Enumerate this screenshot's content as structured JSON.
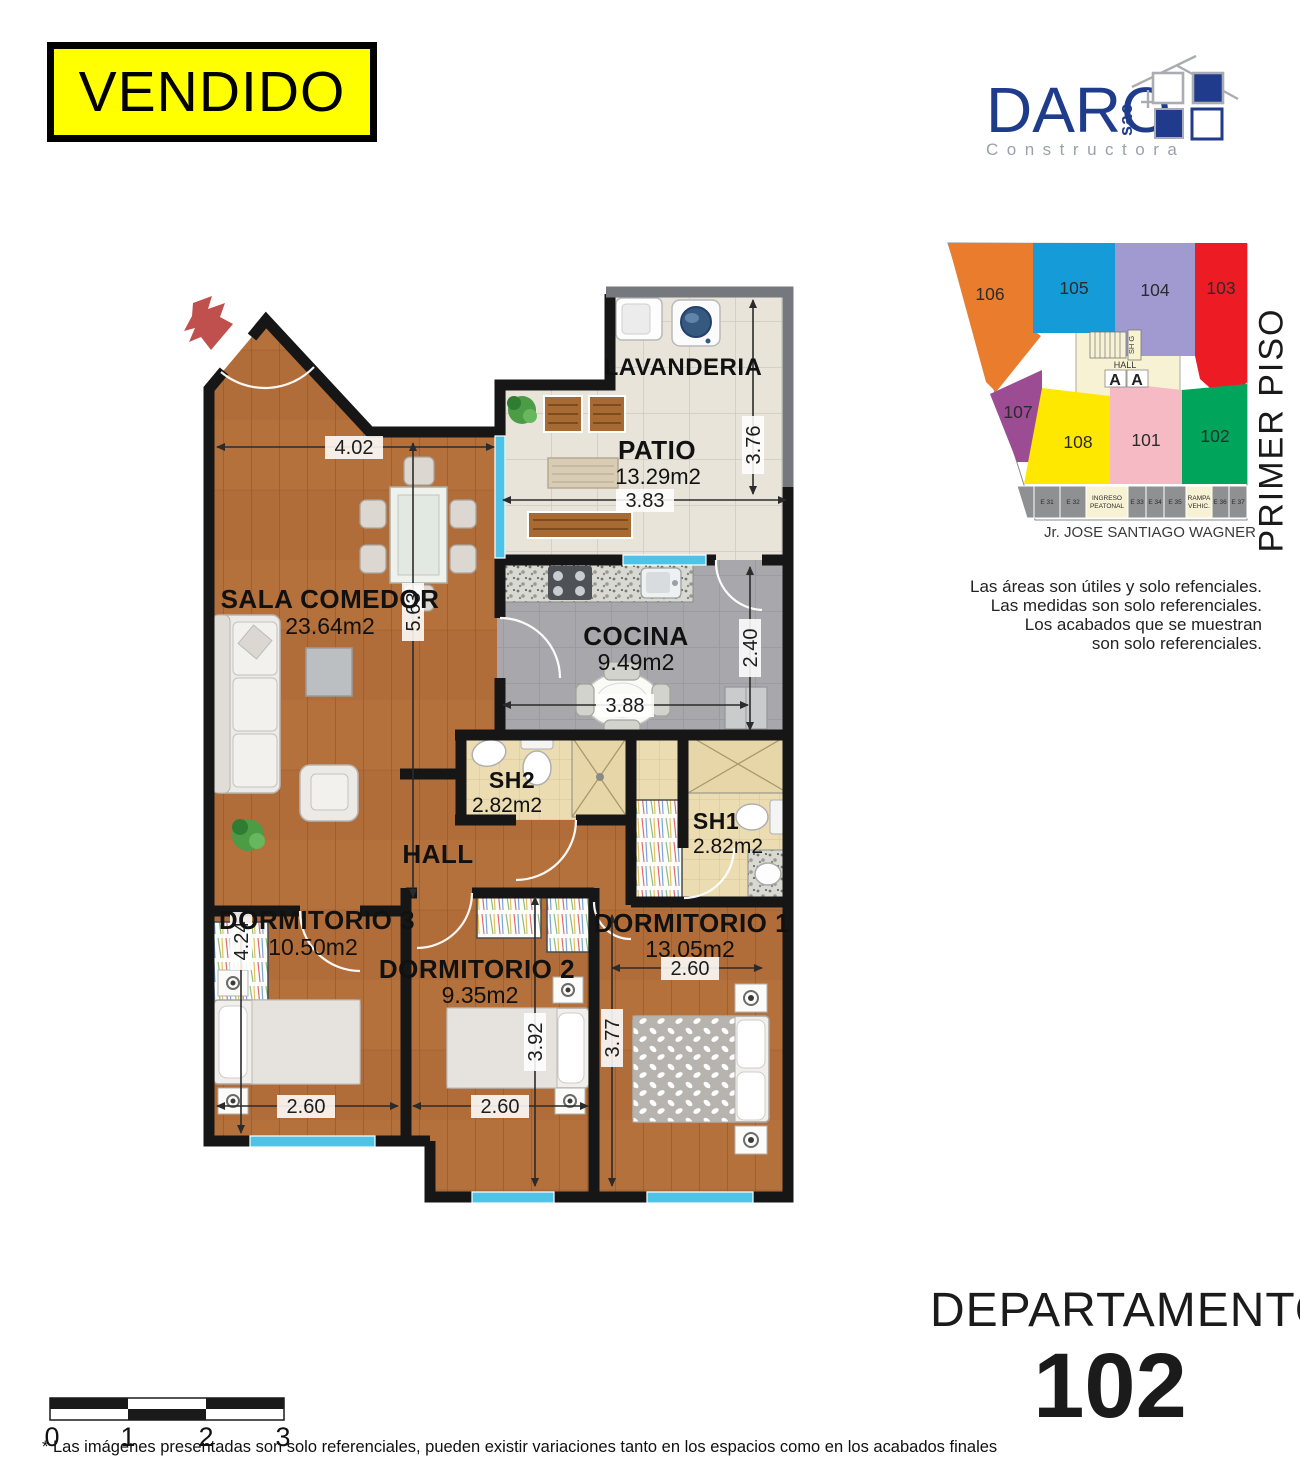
{
  "badge": {
    "label": "VENDIDO"
  },
  "logo": {
    "name": "DARO",
    "suffix": "sac",
    "tagline": "Constructora"
  },
  "palette": {
    "brand_navy": "#1f3c8c",
    "badge_yellow": "#ffff00",
    "window_blue": "#4ec3e6",
    "wall_black": "#161616",
    "wood": "#b4713c"
  },
  "key_plan": {
    "floor_label": "PRIMER PISO",
    "street_label": "Jr. JOSE SANTIAGO WAGNER",
    "hall_label": "HALL",
    "stairs_label": "SH G",
    "section_mark": "A",
    "units": [
      {
        "number": "106",
        "color": "#e97c2d"
      },
      {
        "number": "105",
        "color": "#149bd8"
      },
      {
        "number": "104",
        "color": "#a09ad1"
      },
      {
        "number": "103",
        "color": "#ed1c24"
      },
      {
        "number": "107",
        "color": "#9b4c92"
      },
      {
        "number": "108",
        "color": "#ffe800"
      },
      {
        "number": "101",
        "color": "#f5bac4"
      },
      {
        "number": "102",
        "color": "#00a45a"
      }
    ],
    "parking": [
      {
        "l1": "E 31"
      },
      {
        "l1": "E 32"
      },
      {
        "l1": "INGRESO",
        "l2": "PEATONAL"
      },
      {
        "l1": "E 33"
      },
      {
        "l1": "E 34"
      },
      {
        "l1": "E 35"
      },
      {
        "l1": "RAMPA",
        "l2": "VEHIC."
      },
      {
        "l1": "E 36"
      },
      {
        "l1": "E 37"
      }
    ]
  },
  "disclaimer": {
    "line1": "Las áreas son útiles y solo refenciales.",
    "line2": "Las medidas son solo referenciales.",
    "line3": "Los acabados que se muestran",
    "line4": "son solo referenciales."
  },
  "plan": {
    "rooms": {
      "lavanderia": {
        "name": "LAVANDERIA"
      },
      "patio": {
        "name": "PATIO",
        "area": "13.29m2"
      },
      "sala": {
        "name": "SALA COMEDOR",
        "area": "23.64m2"
      },
      "cocina": {
        "name": "COCINA",
        "area": "9.49m2"
      },
      "sh2": {
        "name": "SH2",
        "area": "2.82m2"
      },
      "sh1": {
        "name": "SH1",
        "area": "2.82m2"
      },
      "hall": {
        "name": "HALL"
      },
      "dorm3": {
        "name": "DORMITORIO 3",
        "area": "10.50m2"
      },
      "dorm2": {
        "name": "DORMITORIO 2",
        "area": "9.35m2"
      },
      "dorm1": {
        "name": "DORMITORIO 1",
        "area": "13.05m2"
      }
    },
    "dims": {
      "sala_w": "4.02",
      "sala_h": "5.63",
      "patio_w": "3.83",
      "patio_h": "3.76",
      "cocina_h": "2.40",
      "cocina_w": "3.88",
      "dorm3_h": "4.24",
      "dorm3_w": "2.60",
      "dorm2_w": "2.60",
      "dorm2_h": "3.92",
      "dorm1_w": "2.60",
      "dorm1_h": "3.77"
    }
  },
  "title": {
    "label": "DEPARTAMENTO",
    "number": "102"
  },
  "scale_bar": {
    "ticks": [
      "0",
      "1",
      "2",
      "3"
    ]
  },
  "footnote": {
    "text": "* Las imágenes presentadas son solo referenciales, pueden existir variaciones tanto en los espacios como en los acabados finales"
  }
}
